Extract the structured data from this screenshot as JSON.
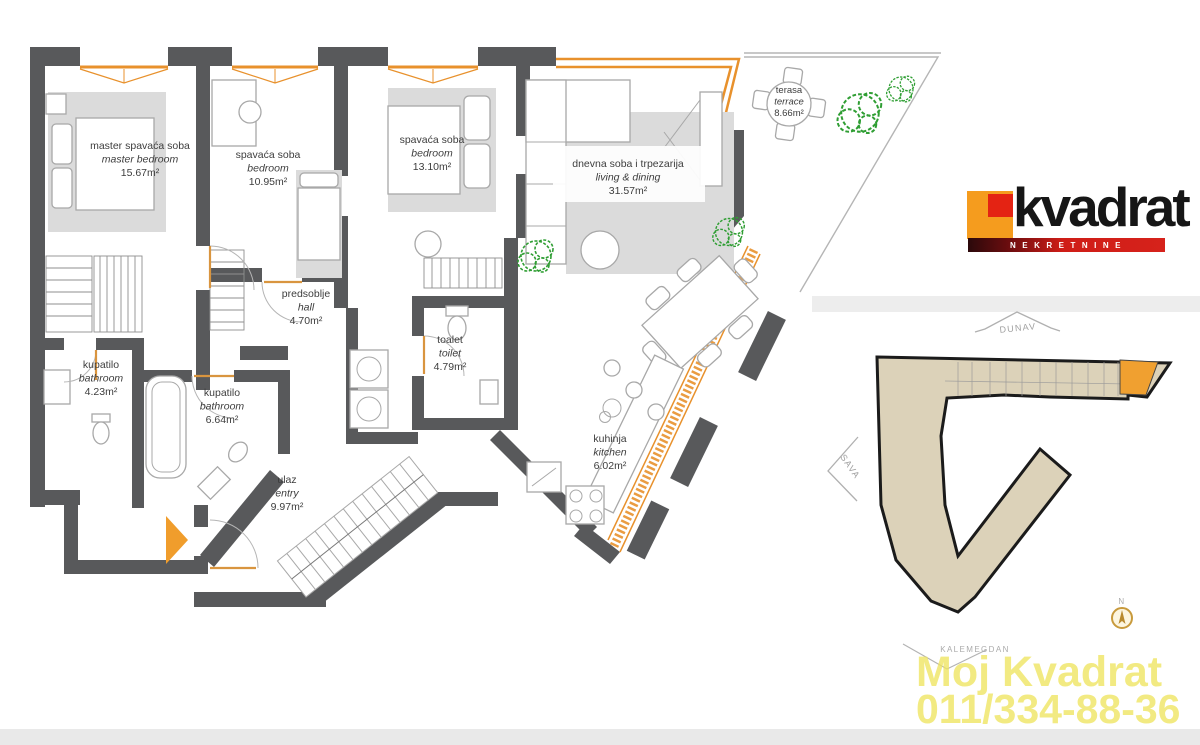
{
  "logo": {
    "brand": "kvadrat",
    "tagline": "NEKRETNINE"
  },
  "watermark": {
    "line1": "Moj Kvadrat",
    "line2": "011/334-88-36"
  },
  "map": {
    "north_label": "DUNAV",
    "river_label": "SAVA",
    "landmark_label": "KALEMEGDAN",
    "compass": "N"
  },
  "rooms": [
    {
      "id": "master-bedroom",
      "sr": "master spavaća soba",
      "en": "master bedroom",
      "area": "15.67m²"
    },
    {
      "id": "bedroom-1",
      "sr": "spavaća soba",
      "en": "bedroom",
      "area": "10.95m²"
    },
    {
      "id": "bedroom-2",
      "sr": "spavaća soba",
      "en": "bedroom",
      "area": "13.10m²"
    },
    {
      "id": "living-dining",
      "sr": "dnevna soba i trpezarija",
      "en": "living & dining",
      "area": "31.57m²"
    },
    {
      "id": "terrace",
      "sr": "terasa",
      "en": "terrace",
      "area": "8.66m²"
    },
    {
      "id": "hall",
      "sr": "predsoblje",
      "en": "hall",
      "area": "4.70m²"
    },
    {
      "id": "toilet",
      "sr": "toalet",
      "en": "toilet",
      "area": "4.79m²"
    },
    {
      "id": "bathroom-1",
      "sr": "kupatilo",
      "en": "bathroom",
      "area": "4.23m²"
    },
    {
      "id": "bathroom-2",
      "sr": "kupatilo",
      "en": "bathroom",
      "area": "6.64m²"
    },
    {
      "id": "entry",
      "sr": "ulaz",
      "en": "entry",
      "area": "9.97m²"
    },
    {
      "id": "kitchen",
      "sr": "kuhinja",
      "en": "kitchen",
      "area": "6.02m²"
    }
  ],
  "colors": {
    "wall_gray": "#58595b",
    "accent_orange": "#e8912c",
    "logo_orange": "#f59c1e",
    "logo_red": "#e42313",
    "plant_green": "#2f9e33",
    "site_fill": "#dcd2b9",
    "unit_highlight": "#f0a030",
    "watermark_yellow": "#efe55f"
  }
}
